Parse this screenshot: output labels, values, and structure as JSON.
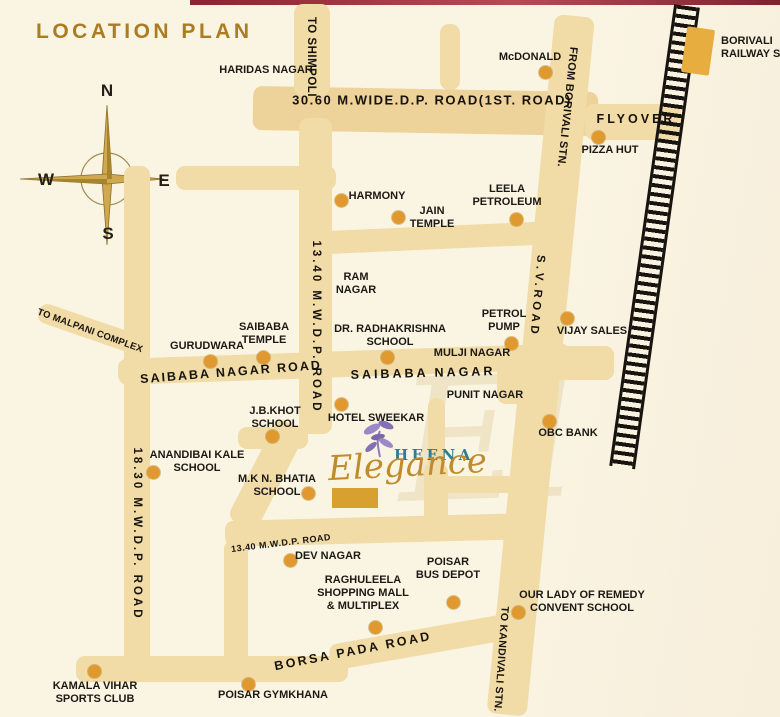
{
  "header": {
    "title": "LOCATION PLAN"
  },
  "compass": {
    "north": "N",
    "south": "S",
    "east": "E",
    "west": "W"
  },
  "logo": {
    "brand": "HEENA",
    "script": "Elegance",
    "watermark": "El"
  },
  "station": {
    "lines": [
      "BORIVALI",
      "RAILWAY STATION"
    ]
  },
  "colors": {
    "background": "#faf5e3",
    "road": "#f1dba6",
    "road_dark": "#edd29a",
    "dot": "#e0992e",
    "site_marker": "#d8a02f",
    "station_marker": "#e7ae3f",
    "railway": "#171410",
    "title": "#ac7c22",
    "brand_teal": "#2e7e90",
    "brand_gold": "#c08a2e",
    "edge_strip": "#8c2330"
  },
  "map": {
    "road_labels": [
      {
        "id": "dp-road-1st",
        "text": "30.60 M.WIDE.D.P. ROAD(1ST. ROAD)",
        "cx": 432,
        "cy": 100,
        "rot": 0,
        "fs": 13,
        "ls": 1.5
      },
      {
        "id": "to-shimpoli",
        "text": "TO SHIMPOLI",
        "cx": 311,
        "cy": 57,
        "rot": 90,
        "fs": 11.5,
        "ls": 0.5
      },
      {
        "id": "from-borivali-stn",
        "text": "FROM BORIVALI STN.",
        "cx": 567,
        "cy": 107,
        "rot": 96,
        "fs": 11,
        "ls": 0.3
      },
      {
        "id": "flyover",
        "text": "FLYOVER",
        "cx": 636,
        "cy": 119,
        "rot": 0,
        "fs": 12.5,
        "ls": 3
      },
      {
        "id": "sv-road",
        "text": "S.V.ROAD",
        "cx": 537,
        "cy": 296,
        "rot": 95,
        "fs": 11.5,
        "ls": 3.5
      },
      {
        "id": "dp-1340-road",
        "text": "13.40 M.W.D.P. ROAD",
        "cx": 316,
        "cy": 327,
        "rot": 90,
        "fs": 11.5,
        "ls": 3
      },
      {
        "id": "mwdp-1830-road",
        "text": "18.30 M.W.D.P. ROAD",
        "cx": 137,
        "cy": 534,
        "rot": 90,
        "fs": 11.5,
        "ls": 3
      },
      {
        "id": "to-malpani-complex",
        "text": "TO MALPANI COMPLEX",
        "cx": 90,
        "cy": 331,
        "rot": 20,
        "fs": 9.5,
        "ls": 0.2
      },
      {
        "id": "saibaba-nagar-road",
        "text": "SAIBABA NAGAR ROAD",
        "cx": 231,
        "cy": 372,
        "rot": -4.5,
        "fs": 12.5,
        "ls": 2
      },
      {
        "id": "saibaba-nagar",
        "text": "SAIBABA NAGAR",
        "cx": 423,
        "cy": 373,
        "rot": -1.5,
        "fs": 12.5,
        "ls": 3
      },
      {
        "id": "dp-1340-road-small",
        "text": "13.40 M.W.D.P. ROAD",
        "cx": 281,
        "cy": 543,
        "rot": -7,
        "fs": 9,
        "ls": 0.5
      },
      {
        "id": "borsa-pada-road",
        "text": "BORSA PADA ROAD",
        "cx": 353,
        "cy": 651,
        "rot": -11,
        "fs": 12.5,
        "ls": 2.5
      },
      {
        "id": "to-kandivali-stn",
        "text": "TO KANDIVALI STN.",
        "cx": 501,
        "cy": 659,
        "rot": 94,
        "fs": 10.5,
        "ls": 0.3
      }
    ],
    "places": [
      {
        "id": "haridas-nagar",
        "lines": [
          "HARIDAS NAGAR"
        ],
        "cx": 266,
        "ty": 64,
        "dot": null
      },
      {
        "id": "mcdonald",
        "lines": [
          "McDONALD"
        ],
        "cx": 530,
        "ty": 51,
        "dot": [
          545,
          72
        ]
      },
      {
        "id": "pizza-hut",
        "lines": [
          "PIZZA HUT"
        ],
        "cx": 610,
        "ty": 144,
        "dot": [
          598,
          137
        ]
      },
      {
        "id": "harmony",
        "lines": [
          "HARMONY"
        ],
        "cx": 377,
        "ty": 190,
        "dot": [
          341,
          200
        ]
      },
      {
        "id": "jain-temple",
        "lines": [
          "JAIN",
          "TEMPLE"
        ],
        "cx": 432,
        "ty": 205,
        "dot": [
          398,
          217
        ]
      },
      {
        "id": "leela-petroleum",
        "lines": [
          "LEELA",
          "PETROLEUM"
        ],
        "cx": 507,
        "ty": 183,
        "dot": [
          516,
          219
        ]
      },
      {
        "id": "ram-nagar",
        "lines": [
          "RAM",
          "NAGAR"
        ],
        "cx": 356,
        "ty": 271,
        "dot": null
      },
      {
        "id": "petrol-pump",
        "lines": [
          "PETROL",
          "PUMP"
        ],
        "cx": 504,
        "ty": 308,
        "dot": [
          511,
          343
        ]
      },
      {
        "id": "vijay-sales",
        "lines": [
          "VIJAY SALES"
        ],
        "cx": 592,
        "ty": 325,
        "dot": [
          567,
          318
        ]
      },
      {
        "id": "dr-radhakrishna-school",
        "lines": [
          "DR. RADHAKRISHNA",
          "SCHOOL"
        ],
        "cx": 390,
        "ty": 323,
        "dot": [
          387,
          357
        ]
      },
      {
        "id": "mulji-nagar",
        "lines": [
          "MULJI NAGAR"
        ],
        "cx": 472,
        "ty": 347,
        "dot": null
      },
      {
        "id": "gurudwara",
        "lines": [
          "GURUDWARA"
        ],
        "cx": 207,
        "ty": 340,
        "dot": [
          210,
          361
        ]
      },
      {
        "id": "saibaba-temple",
        "lines": [
          "SAIBABA",
          "TEMPLE"
        ],
        "cx": 264,
        "ty": 321,
        "dot": [
          263,
          357
        ]
      },
      {
        "id": "jb-khot-school",
        "lines": [
          "J.B.KHOT",
          "SCHOOL"
        ],
        "cx": 275,
        "ty": 405,
        "dot": [
          272,
          436
        ]
      },
      {
        "id": "hotel-sweekar",
        "lines": [
          "HOTEL SWEEKAR"
        ],
        "cx": 376,
        "ty": 412,
        "dot": [
          341,
          404
        ]
      },
      {
        "id": "punit-nagar",
        "lines": [
          "PUNIT NAGAR"
        ],
        "cx": 485,
        "ty": 389,
        "dot": null
      },
      {
        "id": "obc-bank",
        "lines": [
          "OBC BANK"
        ],
        "cx": 568,
        "ty": 427,
        "dot": [
          549,
          421
        ]
      },
      {
        "id": "anandibai-kale-school",
        "lines": [
          "ANANDIBAI KALE",
          "SCHOOL"
        ],
        "cx": 197,
        "ty": 449,
        "dot": [
          153,
          472
        ]
      },
      {
        "id": "mkn-bhatia-school",
        "lines": [
          "M.K N. BHATIA",
          "SCHOOL"
        ],
        "cx": 277,
        "ty": 473,
        "dot": [
          308,
          493
        ]
      },
      {
        "id": "dev-nagar",
        "lines": [
          "DEV NAGAR"
        ],
        "cx": 328,
        "ty": 550,
        "dot": [
          290,
          560
        ]
      },
      {
        "id": "raghuleela-mall",
        "lines": [
          "RAGHULEELA",
          "SHOPPING MALL",
          "& MULTIPLEX"
        ],
        "cx": 363,
        "ty": 574,
        "dot": [
          375,
          627
        ]
      },
      {
        "id": "poisar-bus-depot",
        "lines": [
          "POISAR",
          "BUS DEPOT"
        ],
        "cx": 448,
        "ty": 556,
        "dot": [
          453,
          602
        ]
      },
      {
        "id": "our-lady-convent-school",
        "lines": [
          "OUR LADY OF REMEDY",
          "CONVENT SCHOOL"
        ],
        "cx": 582,
        "ty": 589,
        "dot": [
          518,
          612
        ]
      },
      {
        "id": "kamala-vihar-sports-club",
        "lines": [
          "KAMALA VIHAR",
          "SPORTS CLUB"
        ],
        "cx": 95,
        "ty": 680,
        "dot": [
          94,
          671
        ]
      },
      {
        "id": "poisar-gymkhana",
        "lines": [
          "POISAR GYMKHANA"
        ],
        "cx": 273,
        "ty": 689,
        "dot": [
          248,
          684
        ]
      }
    ]
  }
}
